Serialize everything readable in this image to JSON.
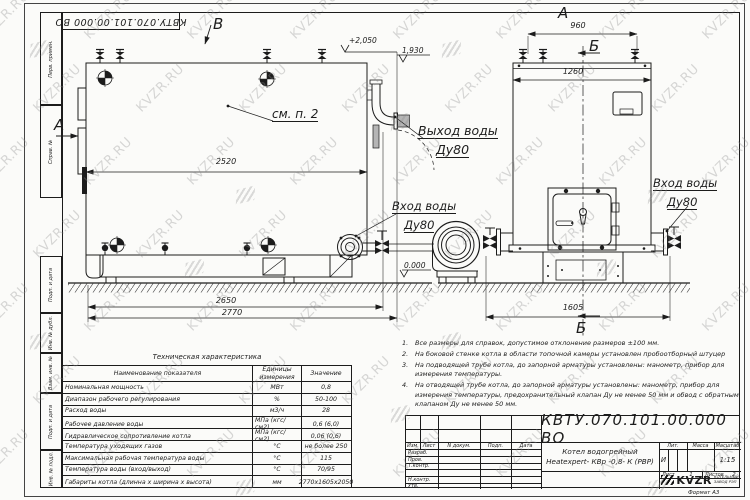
{
  "watermark": {
    "text": "KVZR.RU"
  },
  "sheet": {
    "designation_top": "КВТУ.070.101.00.000 ВО",
    "format_note": "Формат   А3",
    "side_labels": [
      "Перв. примен.",
      "Справ. №",
      "Подп. и дата",
      "Инв. № дубл.",
      "Взам. инв. №",
      "Подп. и дата",
      "Инв. № подл."
    ]
  },
  "views": {
    "label_a_side": "А",
    "label_v_top": "В",
    "label_a_title": "А",
    "label_b_top": "Б",
    "label_b_bottom": "Б",
    "callout_see_note": "см. п. 2",
    "outlet": {
      "line1": "Выход воды",
      "line2": "Ду80"
    },
    "inlet_main": {
      "line1": "Вход воды",
      "line2": "Ду80"
    },
    "inlet_right": {
      "line1": "Вход воды",
      "line2": "Ду80"
    },
    "elev_top": "+2,050",
    "elev_outlet": "1,930",
    "elev_zero": "0.000",
    "dim_2520": "2520",
    "dim_2650": "2650",
    "dim_2770": "2770",
    "dim_960": "960",
    "dim_1260": "1260",
    "dim_1605": "1605"
  },
  "tech_table": {
    "title": "Техническая характеристика",
    "col_name": "Наименование показателя",
    "col_units": "Единицы измерения",
    "col_value": "Значение",
    "rows": [
      {
        "name": "Номинальная мощность",
        "units": "МВт",
        "value": "0,8"
      },
      {
        "name": "Диапазон рабочего регулирования",
        "units": "%",
        "value": "50-100"
      },
      {
        "name": "Расход воды",
        "units": "м3/ч",
        "value": "28"
      },
      {
        "name": "Рабочее давление воды",
        "units": "МПа (кгс/см2)",
        "value": "0,6 (6,0)"
      },
      {
        "name": "Гидравлическое сопротивление котла",
        "units": "МПа (кгс/см2)",
        "value": "0,06 (0,6)"
      },
      {
        "name": "Температура уходящих газов",
        "units": "°С",
        "value": "не более 250"
      },
      {
        "name": "Максимальная рабочая температура воды",
        "units": "°С",
        "value": "115"
      },
      {
        "name": "Температура воды (вход/выход)",
        "units": "°С",
        "value": "70/95"
      },
      {
        "name": "Габариты котла (длинна х ширина х высота)",
        "units": "мм",
        "value": "2770х1605х2050"
      }
    ]
  },
  "notes": [
    {
      "num": "1.",
      "text": "Все размеры для справок, допустимое отклонение размеров ±100 мм."
    },
    {
      "num": "2.",
      "text": "На боковой стенке котла в области топочной камеры установлен пробоотборный штуцер"
    },
    {
      "num": "3.",
      "text": "На  подводящей трубе котла, до запорной арматуры установлены: манометр, прибор для измерения температуры."
    },
    {
      "num": "4.",
      "text": "На отводящей трубе котла, до запорной арматуры установлены: манометр, прибор для измерения температуры, предохранительный клапан Ду не менее 50 мм и обвод с обратным клапаном Ду не менее 50 мм."
    }
  ],
  "title_block": {
    "designation": "КВТУ.070.101.00.000  ВО",
    "product_line1": "Котел водогрейный",
    "product_line2": "Heatexpert- КВр -0,8- К (РВР)",
    "labels": {
      "izm": "Изм.",
      "list": "Лист",
      "n_dokum": "N докум.",
      "podp": "Подп.",
      "data": "Дата",
      "razrab": "Разраб.",
      "prov": "Пров.",
      "t_kontr": "Т.контр.",
      "n_kontr": "Н.контр.",
      "utv": "Утв.",
      "lit": "Лит.",
      "massa": "Масса",
      "masshtab": "Масштаб",
      "sheet": "Лист",
      "sheets": "Листов"
    },
    "values": {
      "lit": "И",
      "scale": "1:15",
      "sheet_no": "1",
      "sheets_total": "2"
    },
    "logo_text": "KVZR",
    "logo_sub1": "КОТЕЛЬНЫЙ",
    "logo_sub2": "ЗАВОД РЭП"
  }
}
